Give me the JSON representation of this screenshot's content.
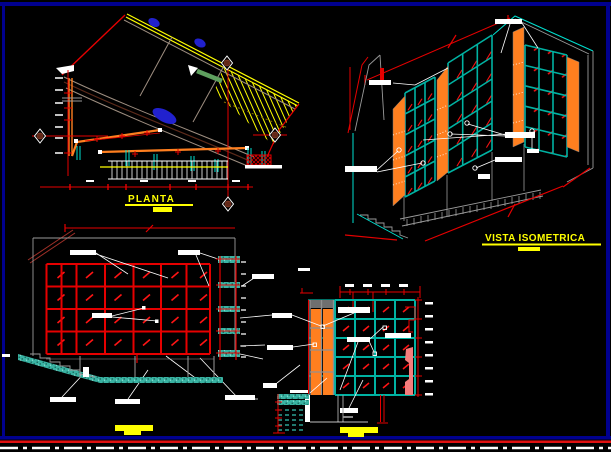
{
  "window": {
    "background": "#000000",
    "frame_color": "#00008F",
    "bottom_red_line": "#E01010",
    "bottom_dashed_line": "#FFFFFF"
  },
  "palette": {
    "red": "#E60000",
    "bright_red": "#FF1414",
    "yellow": "#FFFF00",
    "teal": "#00B2A2",
    "cyan": "#00E0D0",
    "orange": "#FF7F1F",
    "gray": "#9A9A9A",
    "warm_gray": "#9E8E80",
    "maroon": "#5C2A1A",
    "blue": "#2121CE",
    "green": "#5FA05F",
    "salmon": "#F47C7C",
    "dark_red": "#7A3420",
    "white": "#FFFFFF"
  },
  "views": {
    "planta": {
      "title": "PLANTA"
    },
    "isometrica": {
      "title": "VISTA ISOMETRICA"
    }
  }
}
